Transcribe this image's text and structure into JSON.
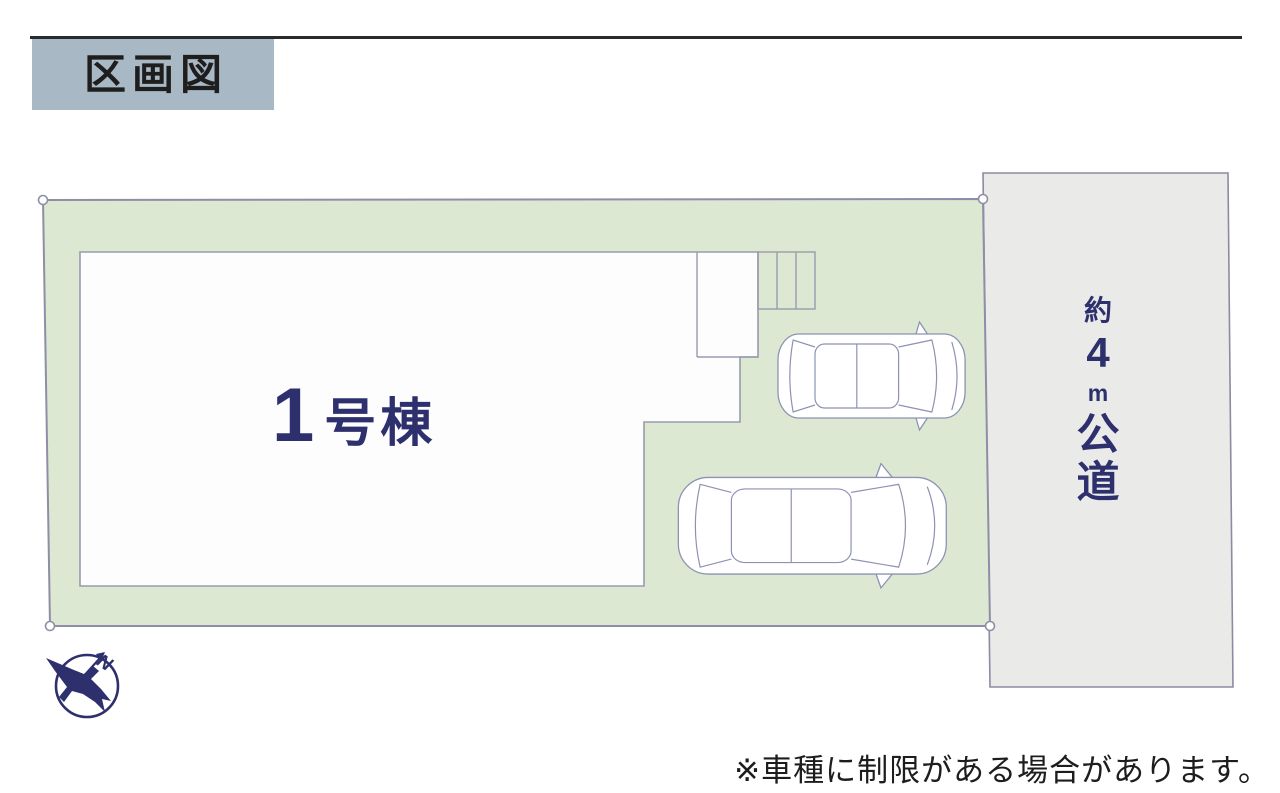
{
  "header": {
    "title": "区画図"
  },
  "building": {
    "number": "1",
    "name_suffix": "号棟"
  },
  "road": {
    "label": "約4m公道",
    "chars": [
      "約",
      "4",
      "m",
      "公",
      "道"
    ]
  },
  "compass": {
    "north_label": "N"
  },
  "note": {
    "text": "※車種に制限がある場合があります。"
  },
  "colors": {
    "rule": "#2b2b2b",
    "header-bg": "#a8b8c4",
    "header-text": "#1e1e1e",
    "plot-fill": "#dde8d2",
    "plot-stroke": "#8e8ea6",
    "road-fill": "#eaeae8",
    "road-stroke": "#8b8ba3",
    "building-fill": "#fdfdfe",
    "building-stroke": "#989bae",
    "car-stroke": "#8d92b5",
    "label-navy": "#2e306e",
    "note-text": "#1d1d1d"
  }
}
